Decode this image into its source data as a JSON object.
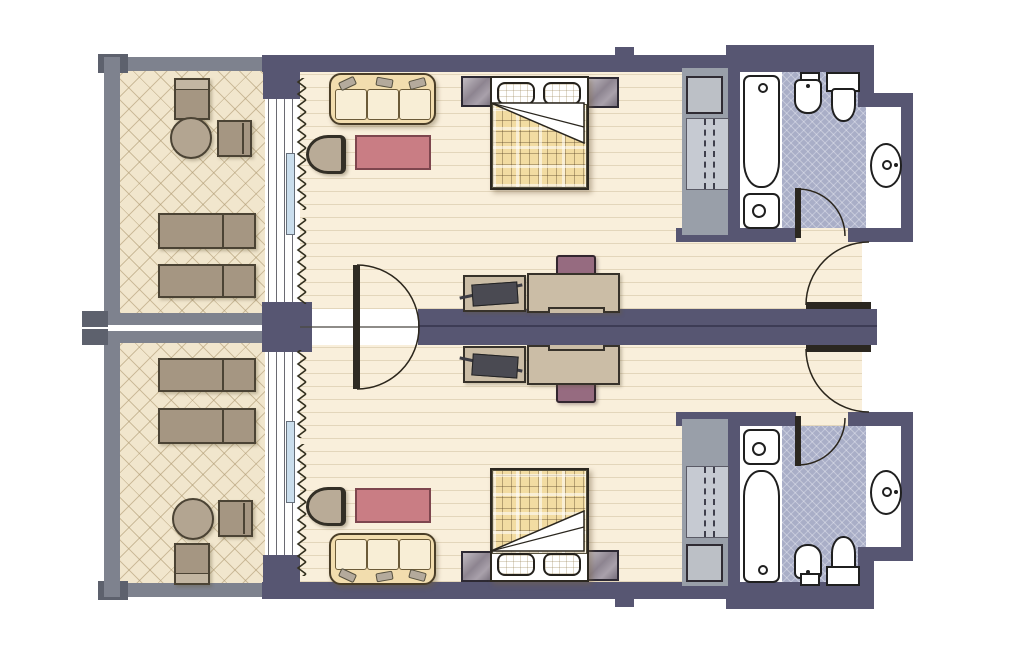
{
  "title": "Floor plan — two mirrored hotel guest rooms with balconies and bathrooms",
  "colors": {
    "wall": "#575672",
    "wall_dark": "#3d3c55",
    "gray_wall": "#7e828e",
    "gray_cap": "#5d616d",
    "room_floor": "#f9efdb",
    "balcony_floor": "#f1e6cd",
    "tile_floor": "#a9aec7",
    "taupe": "#a59682",
    "sofa": "#f2ddae",
    "sofa_cushion": "#f8eed6",
    "rug": "#c97d84",
    "plaid": "#f2dca2",
    "chair_purple": "#966b80",
    "desk_wood": "#cbbda6",
    "wardrobe_gray": "#999fa9",
    "closet_gray": "#c6cad2",
    "window_pane": "#cadeed"
  },
  "plan": {
    "units": [
      {
        "id": "guest-room-top",
        "areas": {
          "balcony": {
            "floor": "diamond lattice tile",
            "furniture": [
              "square chair",
              "round table",
              "side chair",
              "sun lounger",
              "sun lounger"
            ]
          },
          "bedroom": {
            "floor": "wood plank",
            "furniture": [
              "three-seat sofa",
              "pink rug",
              "armchair",
              "double bed with plaid duvet",
              "two pillows",
              "nightstand left",
              "nightstand right",
              "luggage rack with suitcase",
              "desk",
              "desk chair",
              "wardrobe with hanging rail",
              "minibar box"
            ]
          },
          "bathroom": {
            "floor": "blue crosshatch tile",
            "fixtures": [
              "bathtub",
              "sink",
              "bidet",
              "toilet",
              "washbasin in niche"
            ]
          },
          "openings": [
            "sliding balcony window with curtain",
            "connecting door to second room",
            "bathroom door",
            "entry door"
          ]
        }
      },
      {
        "id": "guest-room-bottom",
        "mirror_of": "guest-room-top",
        "areas": {
          "balcony": {
            "floor": "diamond lattice tile",
            "furniture": [
              "sun lounger",
              "sun lounger",
              "round table",
              "side chair",
              "square chair"
            ]
          },
          "bedroom": {
            "floor": "wood plank",
            "furniture": [
              "three-seat sofa",
              "pink rug",
              "armchair",
              "double bed with plaid duvet",
              "two pillows",
              "nightstand left",
              "nightstand right",
              "luggage rack with suitcase",
              "desk",
              "desk chair",
              "wardrobe with hanging rail",
              "minibar box"
            ]
          },
          "bathroom": {
            "floor": "blue crosshatch tile",
            "fixtures": [
              "sink",
              "bathtub",
              "bidet",
              "toilet",
              "washbasin in niche"
            ]
          },
          "openings": [
            "sliding balcony window with curtain",
            "connecting door to first room",
            "bathroom door",
            "entry door"
          ]
        }
      }
    ]
  }
}
